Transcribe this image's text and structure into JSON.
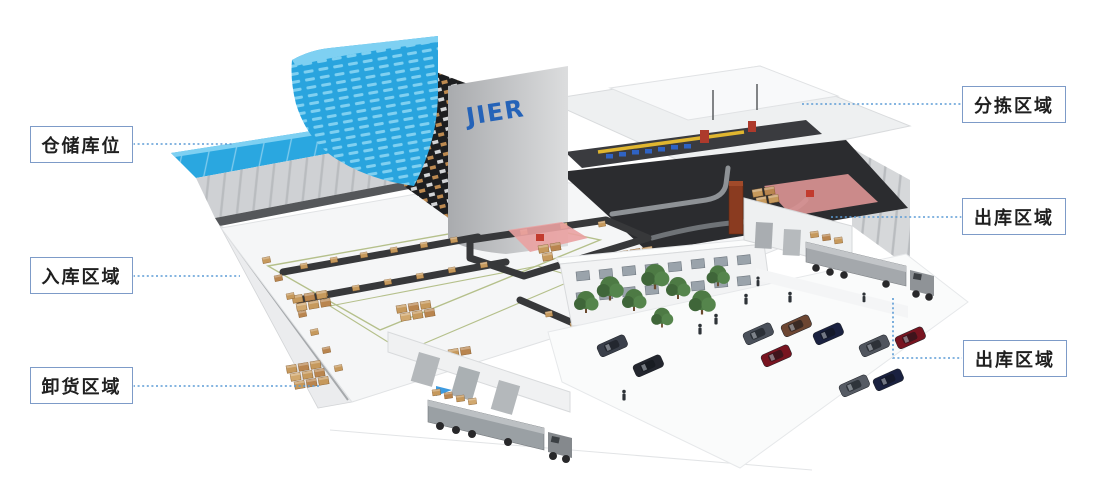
{
  "illustration": {
    "logo_text": "JIER",
    "subject": "isometric-smart-warehouse"
  },
  "labels": {
    "left": [
      {
        "id": "storage-bins",
        "text": "仓储库位"
      },
      {
        "id": "inbound-area",
        "text": "入库区域"
      },
      {
        "id": "unloading-area",
        "text": "卸货区域"
      }
    ],
    "right": [
      {
        "id": "sorting-area",
        "text": "分拣区域"
      },
      {
        "id": "outbound-area-upper",
        "text": "出库区域"
      },
      {
        "id": "outbound-area-lower",
        "text": "出库区域"
      }
    ]
  },
  "colors": {
    "connector_blue": "#5b9bd5",
    "label_border": "#7d9bc8",
    "label_text": "#1f1f1f",
    "logo_blue": "#2563b8",
    "roof_cyan": "#29a7e0"
  }
}
